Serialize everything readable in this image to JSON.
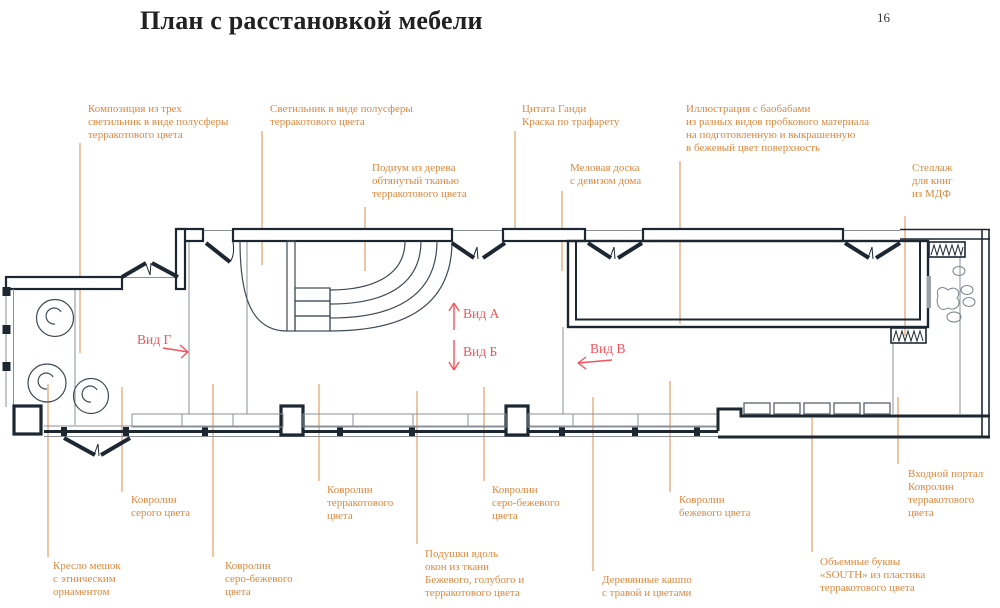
{
  "page": {
    "title": "План с расстановкой мебели",
    "number": "16"
  },
  "annotations": {
    "lamps_composition": {
      "text": "Композиция из трех\nсветильник в виде полусферы\nтерракотового цвета"
    },
    "lamp_hemisphere": {
      "text": "Светильник в виде полусферы\nтерракотового цвета"
    },
    "podium": {
      "text": "Подиум из дерева\nобтянутый тканью\nтерракотового цвета"
    },
    "gandhi_quote": {
      "text": "Цитата Ганди\nКраска по трафарету"
    },
    "chalk_board": {
      "text": "Меловая доска\nс девизом дома"
    },
    "illustration": {
      "text": "Иллюстрация с баобабами\nиз разных видов пробкового материала\nна подготовленную и выкрашенную\nв бежевый цвет поверхность"
    },
    "book_shelf": {
      "text": "Стеллаж\nдля книг\nиз МДФ"
    },
    "carpet_gray": {
      "text": "Ковролин\nсерого цвета"
    },
    "carpet_terracotta": {
      "text": "Ковролин\nтерракотового\nцвета"
    },
    "beanbag_chair": {
      "text": "Кресло мешок\nс этническим\nорнаментом"
    },
    "carpet_gray_beige_1": {
      "text": "Ковролин\nсеро-бежевого\nцвета"
    },
    "window_pillows": {
      "text": "Подушки вдоль\nокон из ткани\nБежевого, голубого и\nтерракотового цвета"
    },
    "carpet_gray_beige_2": {
      "text": "Ковролин\nсеро-бежевого\nцвета"
    },
    "carpet_beige": {
      "text": "Ковролин\nбежевого цвета"
    },
    "wooden_planters": {
      "text": "Деревянные кашпо\nс травой и цветами"
    },
    "south_letters": {
      "text": "Объемные буквы\n«SOUTH» из пластика\nтерракотового цвета"
    },
    "entry_portal": {
      "text": "Входной портал\nКовролин\nтерракотового\nцвета"
    }
  },
  "views": {
    "a": "Вид А",
    "b": "Вид Б",
    "v": "Вид В",
    "g": "Вид Г"
  },
  "colors": {
    "wall": "#1d2732",
    "thin_line": "#8a9097",
    "annotation": "#d9883f",
    "leader": "#e2a066",
    "view_label": "#f4545c",
    "title": "#212121"
  }
}
